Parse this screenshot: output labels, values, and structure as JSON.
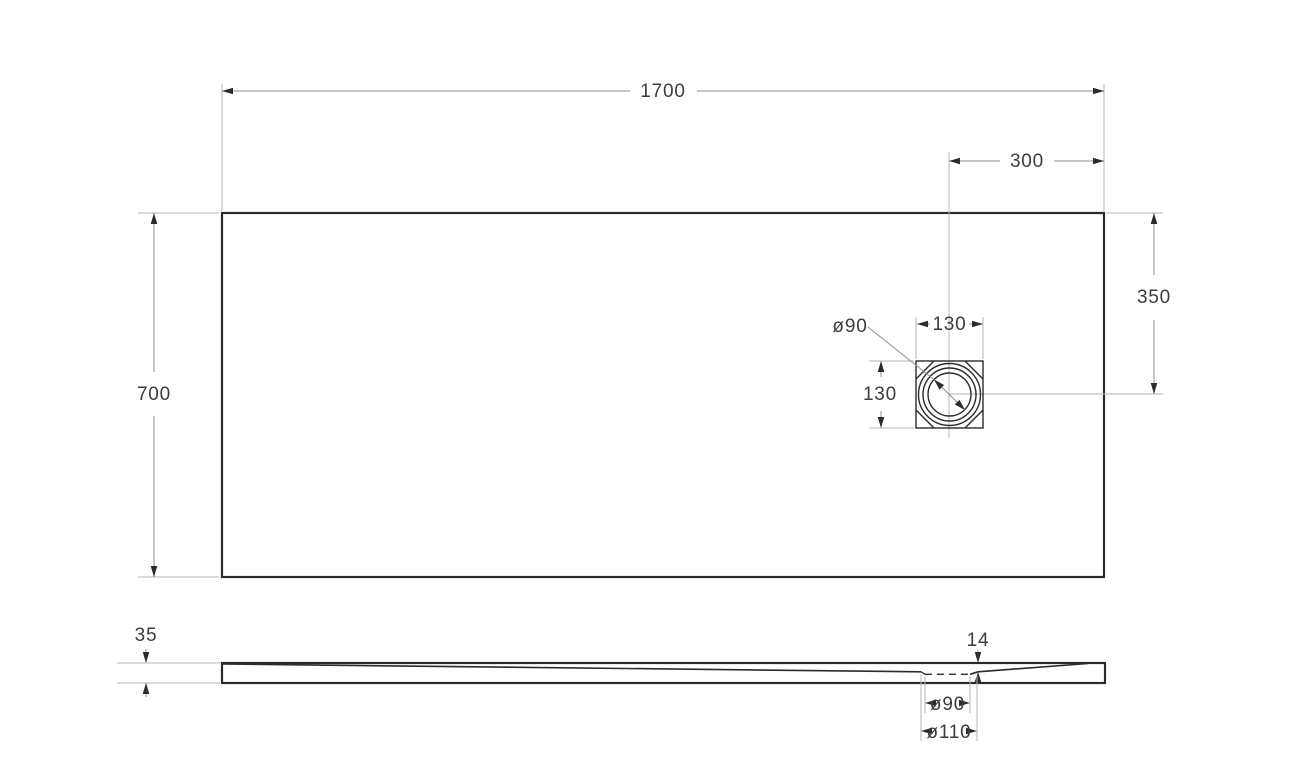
{
  "drawing_type": "technical-dimension-drawing",
  "colors": {
    "background": "#ffffff",
    "outline": "#2b2b2b",
    "dimension_line": "#8f8f8f",
    "extension_line": "#b5b5b5",
    "text": "#3c3c3c"
  },
  "top_view": {
    "length": "1700",
    "width": "700",
    "drain_offset_right": "300",
    "drain_offset_top": "350",
    "drain_box_width": "130",
    "drain_box_height": "130",
    "drain_diameter": "ø90"
  },
  "side_view": {
    "thickness": "35",
    "drain_thickness": "14",
    "drain_hole": "ø90",
    "drain_recess": "ø110"
  }
}
